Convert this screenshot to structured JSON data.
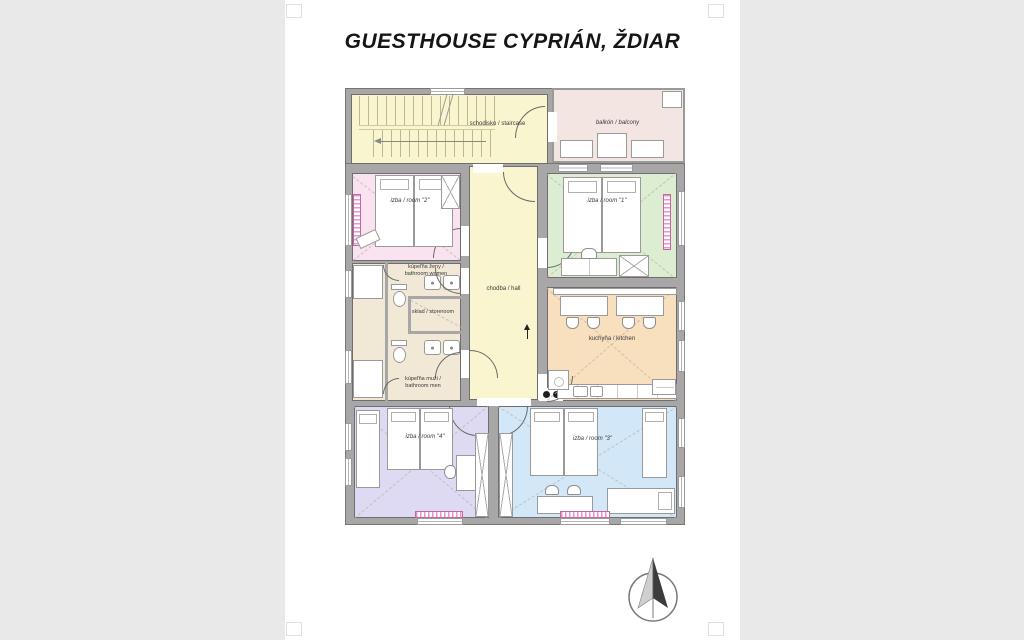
{
  "title": "GUESTHOUSE CYPRIÁN, ŽDIAR",
  "plan": {
    "rooms": {
      "staircase": {
        "label": "schodisko / staircase",
        "color": "#f8f5cf"
      },
      "balcony": {
        "label": "balkón / balcony",
        "color": "#f3e6e2"
      },
      "hall": {
        "label": "chodba / hall",
        "color": "#f8f5cf"
      },
      "room1": {
        "label": "izba / room \"1\"",
        "color": "#dcedd2"
      },
      "room2": {
        "label": "izba / room \"2\"",
        "color": "#fae3f0"
      },
      "room3": {
        "label": "izba / room \"3\"",
        "color": "#d2e7f8"
      },
      "room4": {
        "label": "izba / room \"4\"",
        "color": "#dedaf4"
      },
      "bathroom_women": {
        "label_line1": "kúpeľňa ženy /",
        "label_line2": "bathroom women",
        "color": "#f1e8d6"
      },
      "bathroom_men": {
        "label_line1": "kúpeľňa muži /",
        "label_line2": "bathroom men",
        "color": "#f1e8d6"
      },
      "storeroom": {
        "label": "sklad / storeroom",
        "color": "#f1e8d6"
      },
      "kitchen": {
        "label": "kuchyňa / kitchen",
        "color": "#f8dfbd"
      }
    },
    "wall_color": "#a8a6a6",
    "icons": {
      "compass": "north-arrow-icon"
    }
  }
}
